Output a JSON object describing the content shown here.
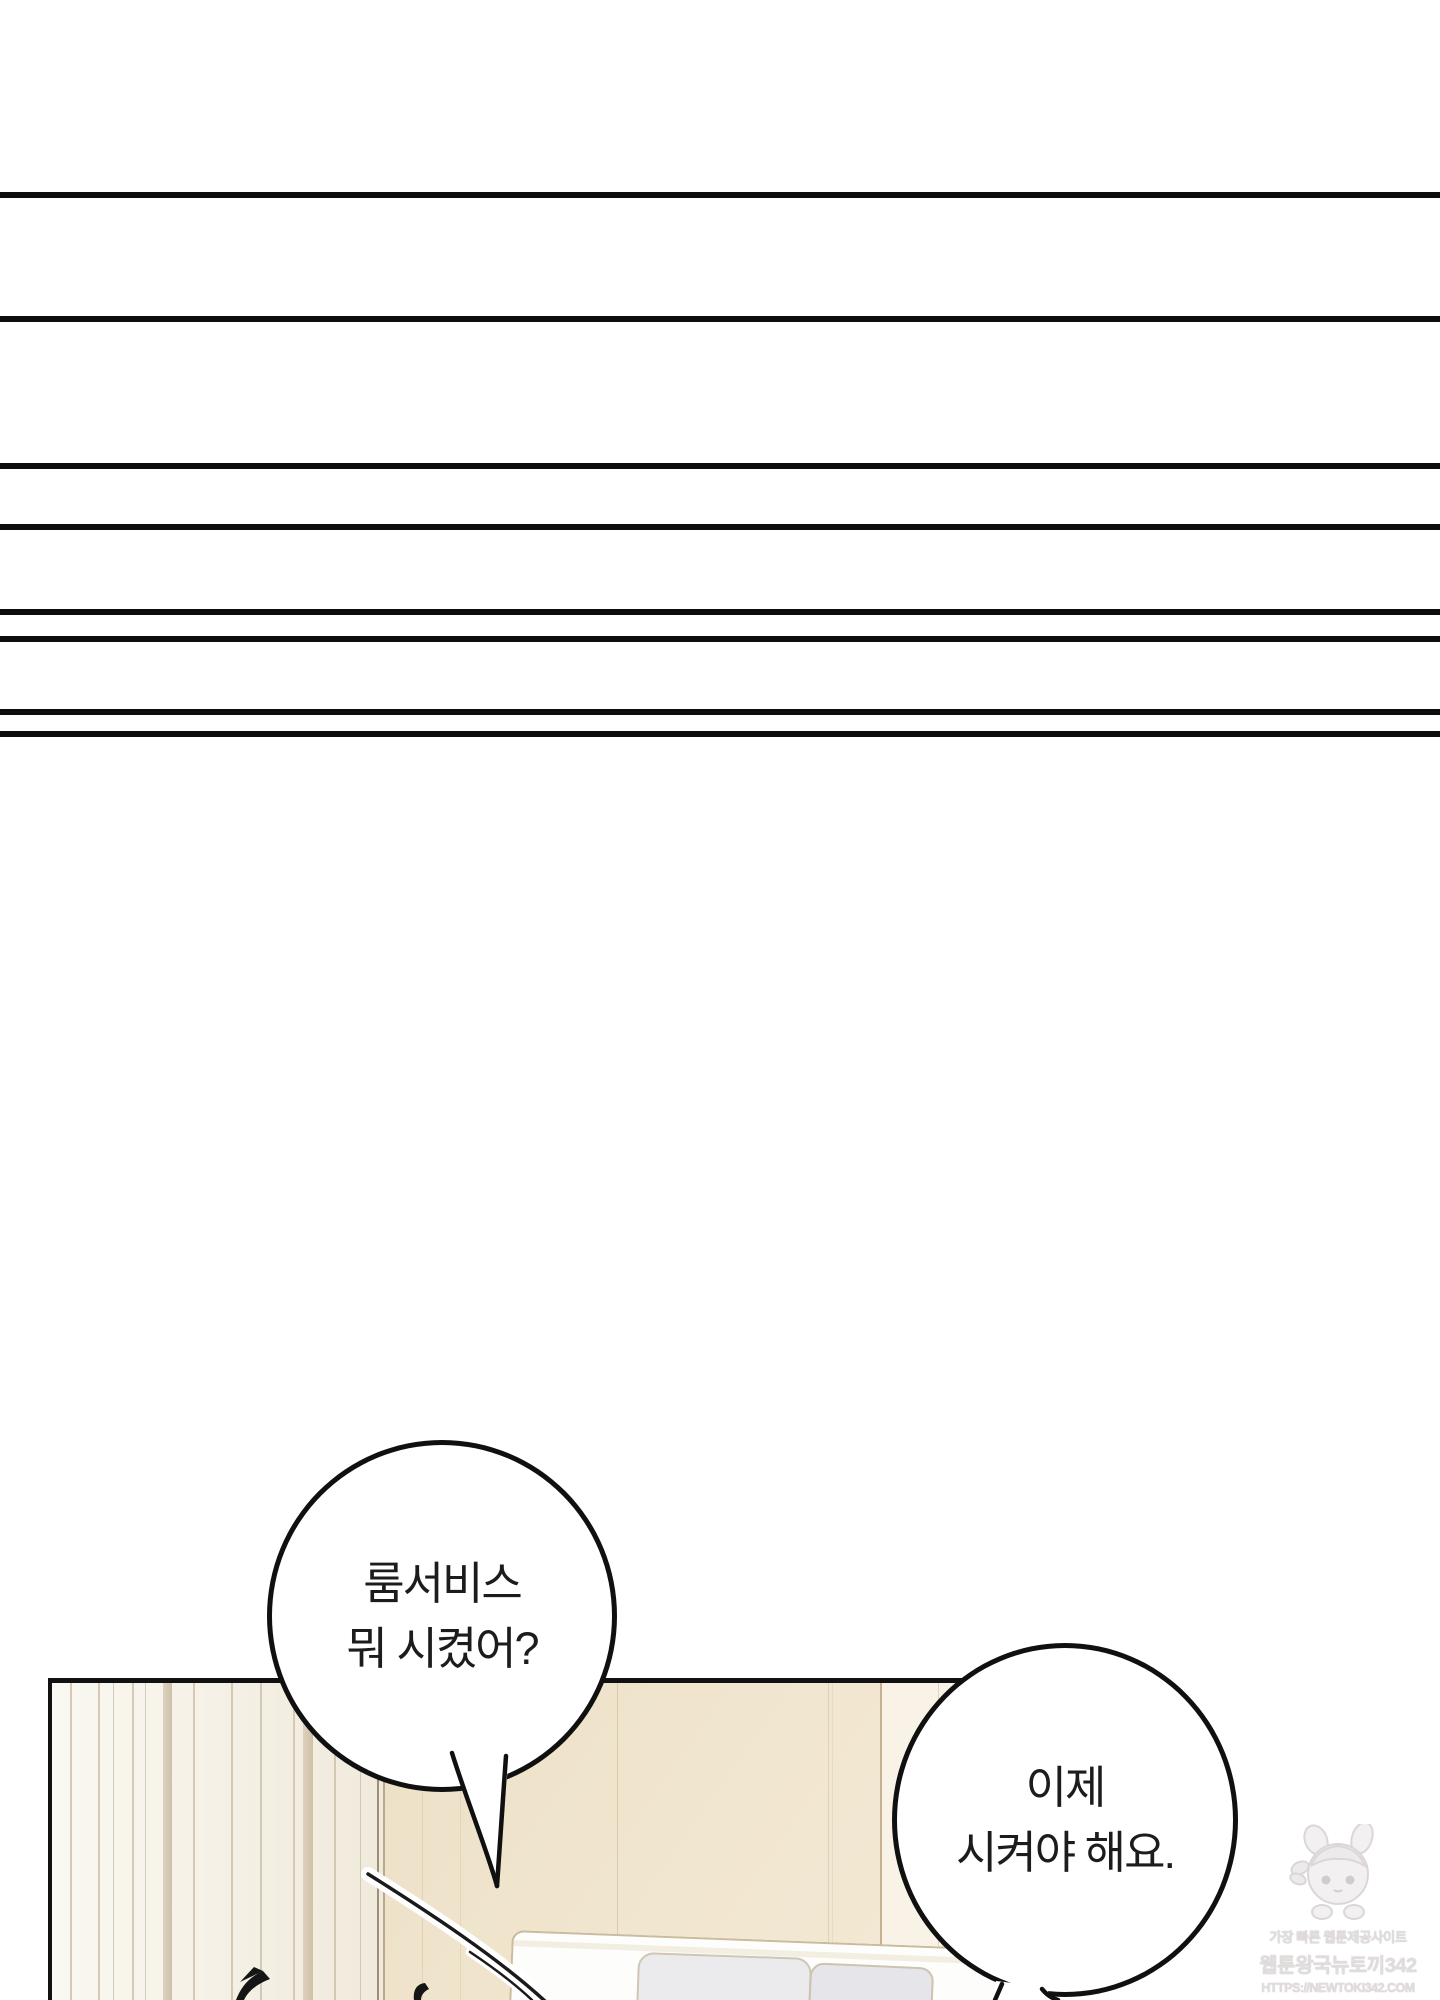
{
  "page": {
    "type": "webtoon episode page",
    "background_color": "#ffffff",
    "ink_color": "#101010"
  },
  "decor": {
    "transition_lines_count": 8,
    "transition_line_y_positions": [
      192,
      316,
      463,
      524,
      609,
      636,
      709,
      731
    ]
  },
  "panel": {
    "description": "hotel room interior: striped curtain at left, beige walls, white bed headboard with pillows",
    "wall_color": "#efe3cc",
    "wall_right_color": "#f8f3e6",
    "curtain_color": "#f7f4ec"
  },
  "speech_bubbles": [
    {
      "id": "bubble-1",
      "lines": [
        "룸서비스",
        "뭐 시켰어?"
      ]
    },
    {
      "id": "bubble-2",
      "lines": [
        "이제",
        "시켜야 해요."
      ]
    }
  ],
  "watermark": {
    "site_tagline": "가장 빠른 웹툰제공사이트",
    "site_name": "웹툰왕국뉴토끼342",
    "site_url": "HTTPS://NEWTOKI342.COM"
  }
}
